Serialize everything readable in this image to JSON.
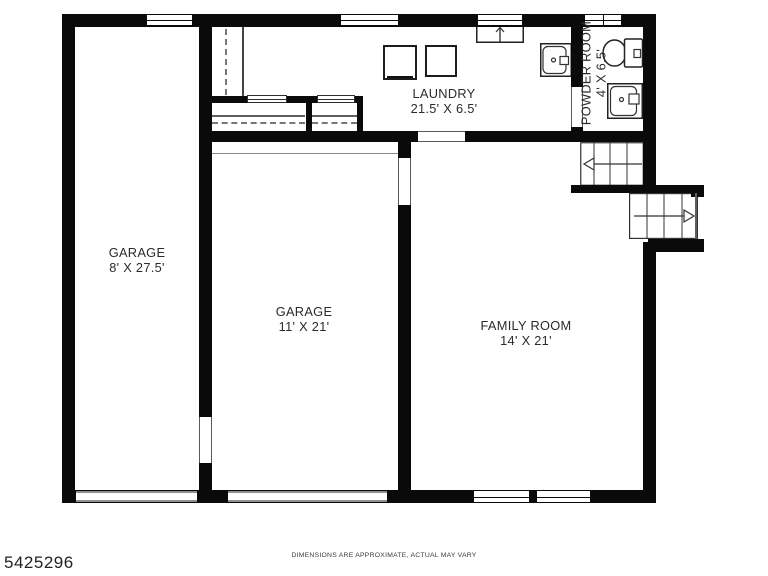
{
  "plan": {
    "rooms": {
      "garage_left": {
        "name": "GARAGE",
        "dims": "8' X 27.5'"
      },
      "garage_main": {
        "name": "GARAGE",
        "dims": "11' X 21'"
      },
      "family_room": {
        "name": "FAMILY ROOM",
        "dims": "14' X 21'"
      },
      "laundry": {
        "name": "LAUNDRY",
        "dims": "21.5' X 6.5'"
      },
      "powder_room": {
        "name": "POWDER ROOM",
        "dims": "4' X 6.5'"
      }
    },
    "fixtures": [
      "washer",
      "dryer",
      "laundry-sink",
      "furnace",
      "toilet",
      "vanity-sink",
      "stairs-up",
      "stairs-down",
      "closet-rods",
      "garage-door-left",
      "garage-door-main"
    ],
    "colors": {
      "wall": "#0a0a0a",
      "background": "#ffffff",
      "label_text": "#2b2b2b",
      "garage_door_line": "#8f8f8f",
      "fixture_line": "#333333"
    }
  },
  "footer": {
    "listing_id": "5425296",
    "disclaimer": "DIMENSIONS ARE APPROXIMATE, ACTUAL MAY VARY"
  }
}
